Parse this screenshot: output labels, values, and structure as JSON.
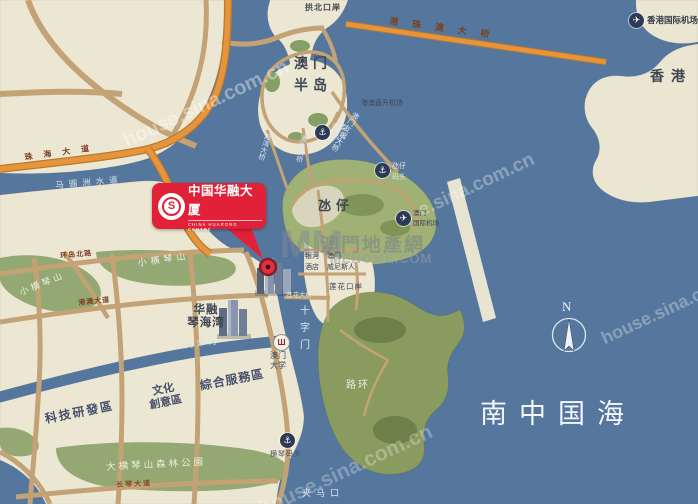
{
  "callout": {
    "title": "中国华融大厦",
    "subtitle": "CHINA HUARONG CENTRE",
    "logo_letter": "S"
  },
  "regions": {
    "macau_peninsula_l1": "澳门",
    "macau_peninsula_l2": "半岛",
    "taipa": "氹仔",
    "coloane": "路环",
    "hongkong": "香港",
    "sea": "南中国海",
    "hill_west": "小横琴山",
    "hill_north": "小横琴山",
    "forest_park": "大横琴山森林公園"
  },
  "zones": {
    "tech": "科技研發區",
    "culture_l1": "文化",
    "culture_l2": "創意區",
    "service": "綜合服務區",
    "huarong_bay_l1": "华融",
    "huarong_bay_l2": "琴海湾"
  },
  "checkpoints": {
    "gongbei": "拱北口岸",
    "lianhua": "莲花口岸"
  },
  "piers": {
    "hk_macau_l1": "港澳",
    "hk_macau_l2": "码头",
    "taipa_l1": "氹仔",
    "taipa_l2": "码头",
    "hengqin": "横琴码头"
  },
  "bridges": {
    "hzmb": "港珠澳大桥",
    "friendship": "澳门友谊大桥",
    "xiwan": "西湾大桥",
    "aodang": "澳氹大桥",
    "lianhua": "莲花大桥"
  },
  "airports": {
    "heliport": "港澳直升机场",
    "macau_l1": "澳门",
    "macau_l2": "国际机场",
    "hongkong": "香港国际机场"
  },
  "landmarks": {
    "um_l1": "澳门",
    "um_l2": "大学",
    "galaxy_l1": "银河",
    "galaxy_l2": "酒店",
    "venetian_l1": "澳门",
    "venetian_l2": "威尼斯人"
  },
  "waterways": {
    "maliuzhou": "马骝洲水道",
    "shizimen": "十字门",
    "tianmu": "天沐河",
    "jiamakou": "夹马口"
  },
  "roads": {
    "zhuhai": "珠海大道",
    "huandao_north": "环岛北路",
    "gangao": "港澳大道",
    "changqin": "长琴大道"
  },
  "compass": {
    "north": "N"
  },
  "icons": {
    "anchor": "⚓",
    "plane": "✈",
    "university": "Ш"
  },
  "watermarks": {
    "sina": "house.sina.com.cn",
    "sina_partial": "e.sina.com.cn",
    "mm": "MM",
    "site_cn": "澳門地產網",
    "site_en": "MEHOME.COM"
  },
  "colors": {
    "water": "#56779d",
    "land": "#ece7d3",
    "green": "#9fb174",
    "road": "#c3a275",
    "highway": "#e6953d",
    "callout_red": "#e02138"
  }
}
